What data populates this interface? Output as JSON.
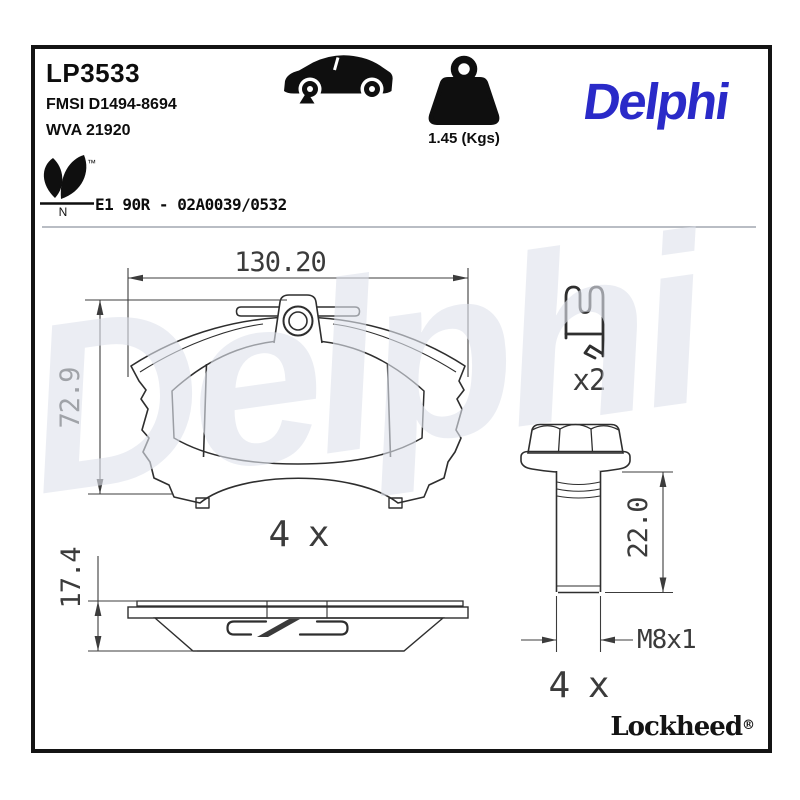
{
  "header": {
    "part_number": "LP3533",
    "fmsi_code": "FMSI D1494-8694",
    "wva_code": "WVA 21920",
    "weight": "1.45 (Kgs)",
    "brand_logo": "Delphi",
    "eco_trademark": "™",
    "eco_letter": "N",
    "homologation": "E1 90R - 02A0039/0532"
  },
  "diagram": {
    "pad_front_view": {
      "width_mm": "130.20",
      "height_mm": "72.9",
      "quantity": "4 x"
    },
    "pad_side_view": {
      "thickness_mm": "17.4"
    },
    "retainer_clip": {
      "quantity": "x2"
    },
    "guide_bolt": {
      "length_mm": "22.0",
      "thread_spec": "M8x1",
      "quantity": "4 x"
    }
  },
  "watermark_text": "Delphi",
  "footer": {
    "sub_brand": "Lockheed",
    "registered_mark": "®"
  },
  "colors": {
    "brand_blue": "#2A2AC8",
    "watermark": "#DFE3EC",
    "friction_top": "#D0D5DD",
    "friction_bottom": "#B8BEC9",
    "outline": "#2E2E2E"
  }
}
